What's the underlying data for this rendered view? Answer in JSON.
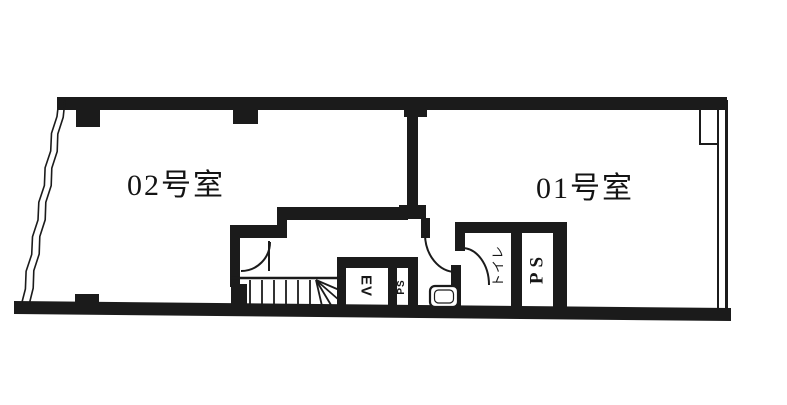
{
  "floorplan": {
    "rooms": [
      {
        "id": "room-02",
        "label": "02号室"
      },
      {
        "id": "room-01",
        "label": "01号室"
      }
    ],
    "facilities": {
      "elevator": "EV",
      "pipe_space_small": "PS",
      "toilet": "トイレ",
      "pipe_space": "PS"
    },
    "colors": {
      "ink": "#1b1b1b",
      "background": "#ffffff"
    }
  }
}
